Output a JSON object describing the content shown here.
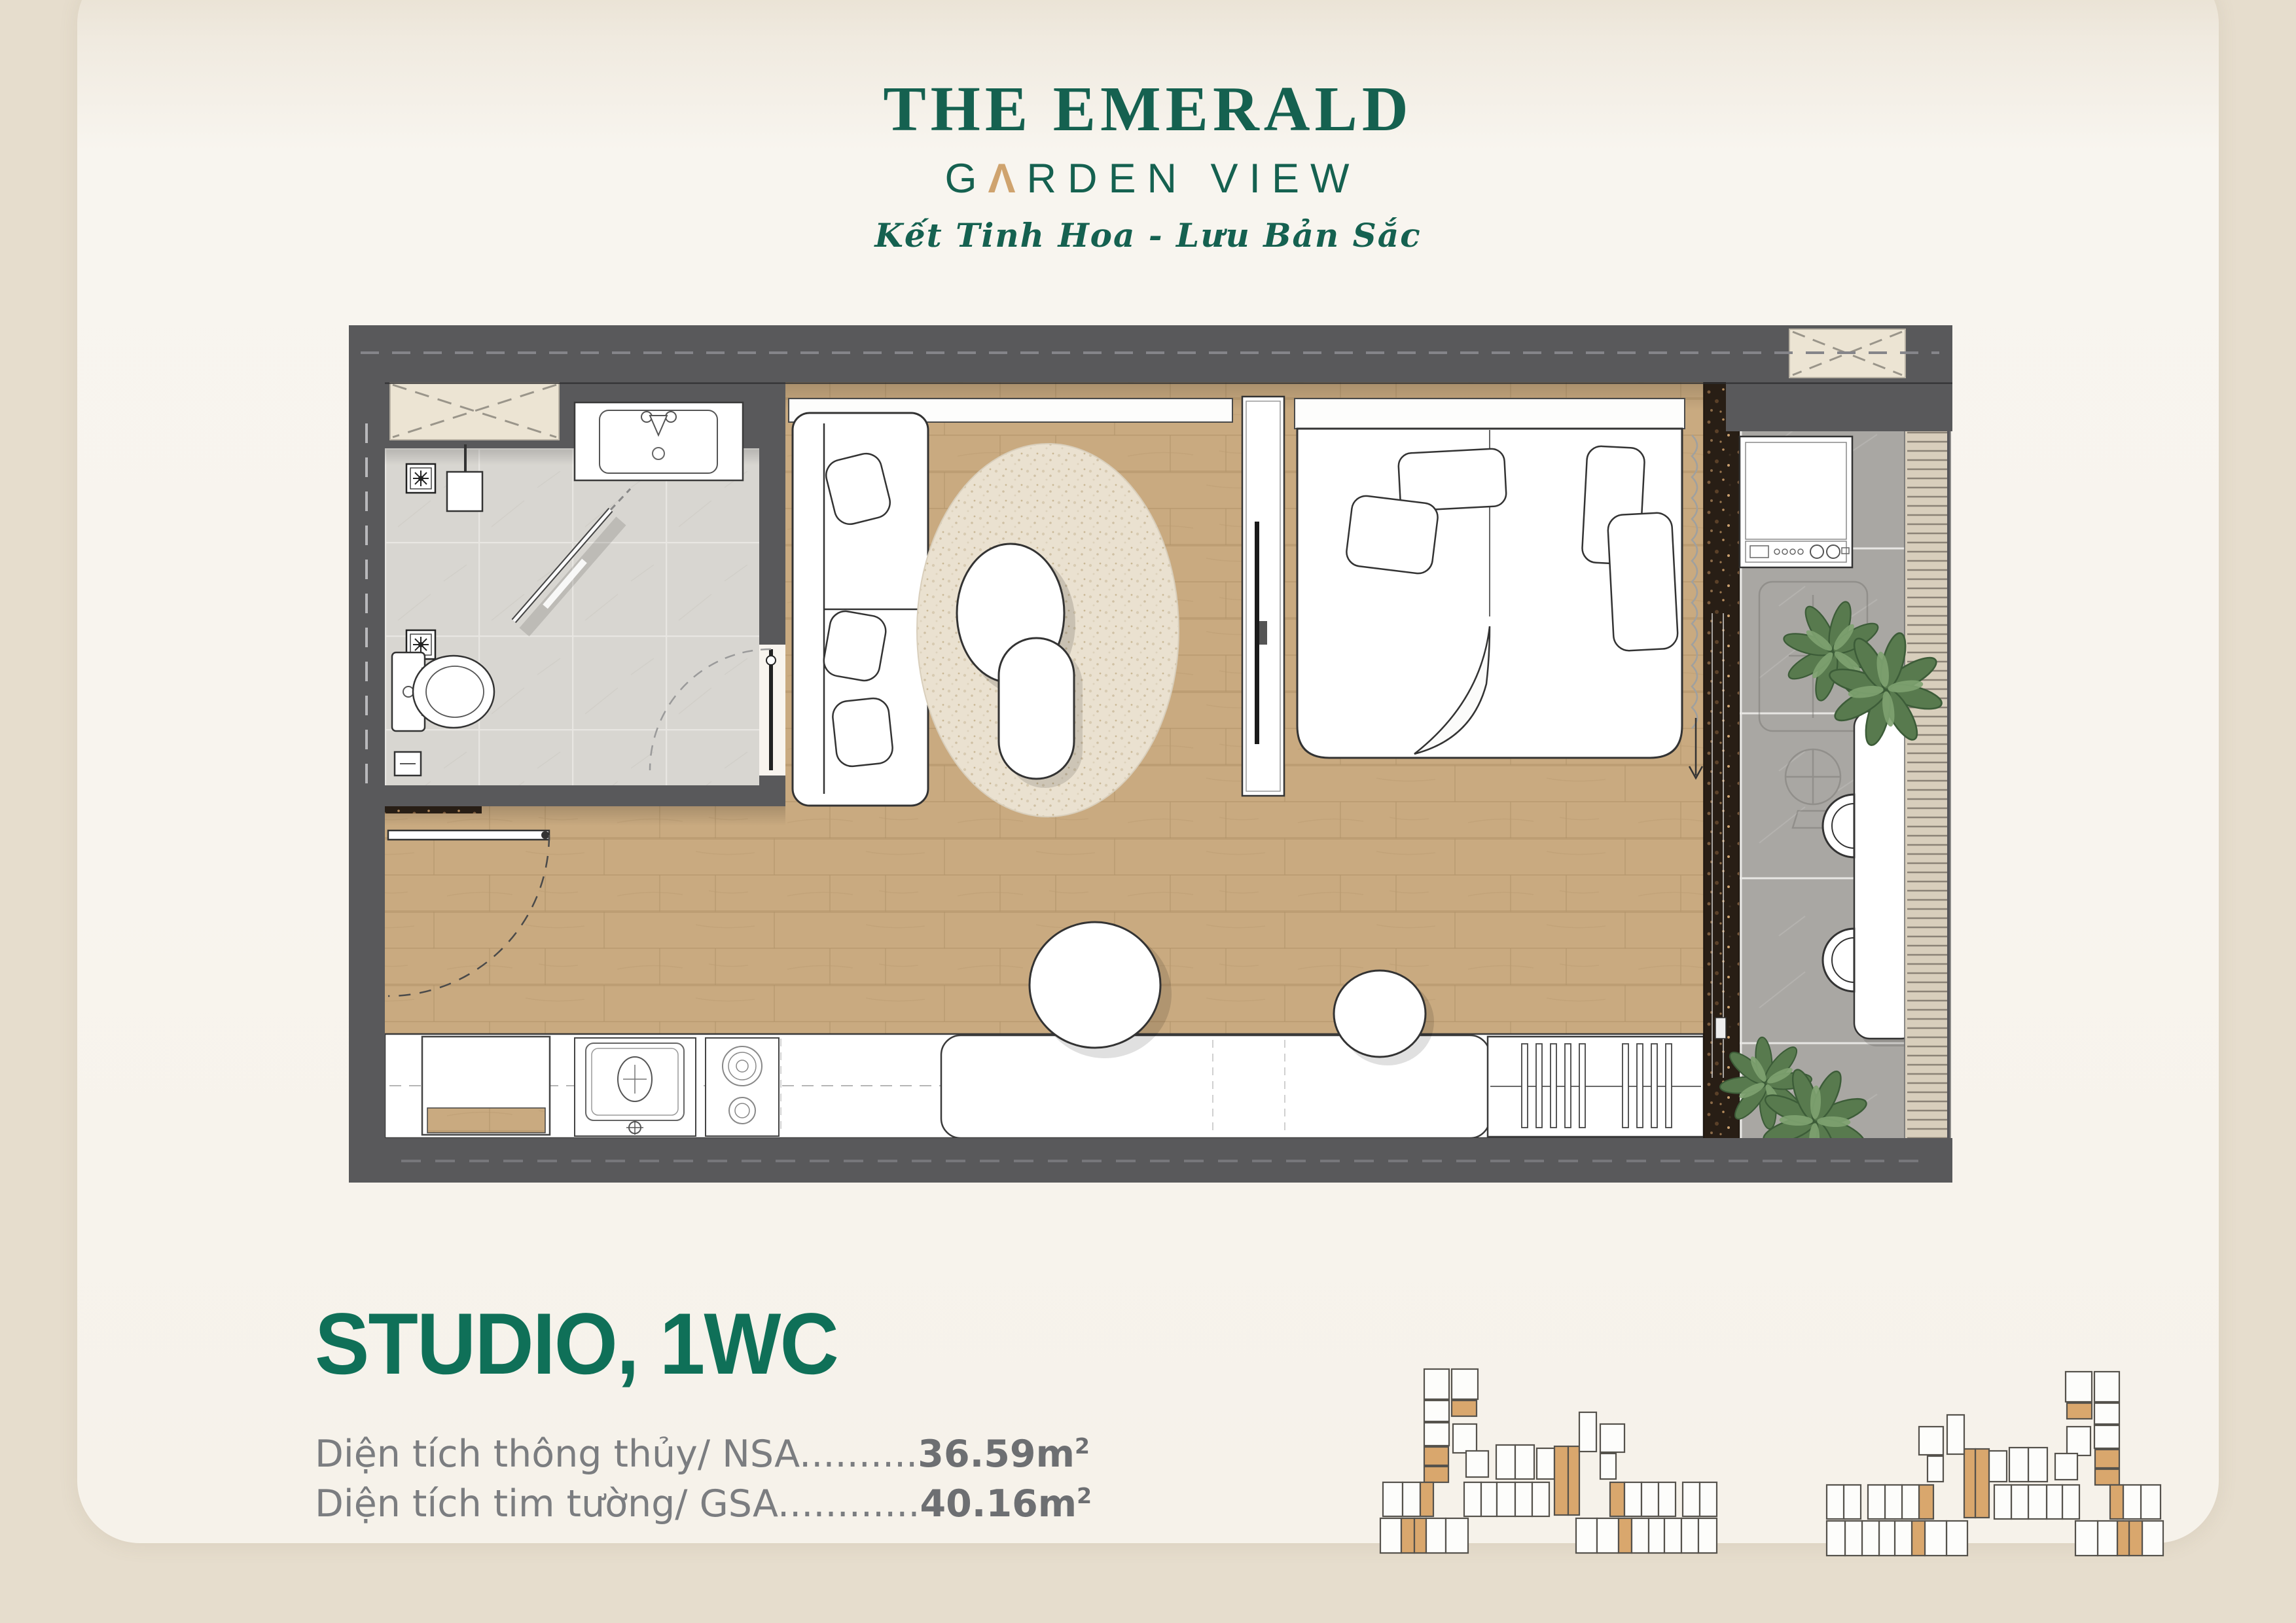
{
  "page": {
    "background_top": "#ece4d7",
    "background_bottom": "#d4c9b9",
    "card_color": "#f8f5ef"
  },
  "brand": {
    "title": "THE EMERALD",
    "garden": {
      "g": "G",
      "a": "Λ",
      "rest": "RDEN VIEW"
    },
    "tagline": "Kết Tinh Hoa - Lưu Bản Sắc",
    "green": "#156150",
    "gold": "#cfa36e"
  },
  "unit": {
    "title": "STUDIO, 1WC",
    "areas": [
      {
        "label": "Diện tích thông thủy/ NSA",
        "dots": "..........",
        "value": "36.59",
        "suffix": "m",
        "sup": "2"
      },
      {
        "label": "Diện tích tim tường/ GSA",
        "dots": "............",
        "value": "40.16",
        "suffix": "m",
        "sup": "2"
      }
    ]
  },
  "floorplan": {
    "rooms": [
      "bathroom",
      "living-bedroom",
      "kitchen",
      "balcony"
    ],
    "colors": {
      "wall": "#59595b",
      "wood_floor": "#c9aa80",
      "bath_tile": "#d8d6d1",
      "balcony_tile": "#a9a7a3",
      "granite_sill": "#281e15",
      "shaft_hatch": "#ece4d3",
      "furniture_stroke": "#333333",
      "rug": "#eae1d0"
    }
  },
  "key_plan": {
    "unit_fill": "#fdfdfb",
    "unit_stroke": "#55524c",
    "highlight": "#d9a76d",
    "cluster_width": 524,
    "clusters": [
      {
        "mirror": false
      },
      {
        "mirror": true
      }
    ],
    "rects": [
      [
        76,
        8,
        38,
        46
      ],
      [
        118,
        8,
        40,
        46
      ],
      [
        76,
        56,
        38,
        32
      ],
      [
        118,
        56,
        38,
        24,
        1
      ],
      [
        76,
        90,
        38,
        35
      ],
      [
        120,
        92,
        36,
        44
      ],
      [
        76,
        127,
        37,
        28,
        1
      ],
      [
        76,
        157,
        37,
        24,
        1
      ],
      [
        140,
        133,
        34,
        40
      ],
      [
        186,
        124,
        29,
        52
      ],
      [
        215,
        124,
        29,
        52
      ],
      [
        248,
        129,
        27,
        47
      ],
      [
        275,
        126,
        21,
        105,
        1
      ],
      [
        296,
        126,
        17,
        105,
        1
      ],
      [
        313,
        74,
        26,
        60
      ],
      [
        345,
        92,
        37,
        43
      ],
      [
        345,
        137,
        24,
        39
      ],
      [
        13,
        181,
        30,
        52
      ],
      [
        43,
        181,
        27,
        52
      ],
      [
        70,
        181,
        20,
        52,
        1
      ],
      [
        137,
        181,
        26,
        52
      ],
      [
        163,
        181,
        24,
        52
      ],
      [
        187,
        181,
        28,
        52
      ],
      [
        215,
        181,
        26,
        52
      ],
      [
        241,
        181,
        26,
        52
      ],
      [
        360,
        181,
        22,
        52,
        1
      ],
      [
        382,
        181,
        26,
        52
      ],
      [
        408,
        181,
        26,
        52
      ],
      [
        434,
        181,
        26,
        52
      ],
      [
        471,
        181,
        26,
        52
      ],
      [
        497,
        181,
        26,
        52
      ],
      [
        9,
        236,
        32,
        53
      ],
      [
        41,
        236,
        20,
        53,
        1
      ],
      [
        61,
        236,
        18,
        53,
        1
      ],
      [
        79,
        236,
        30,
        53
      ],
      [
        109,
        236,
        34,
        53
      ],
      [
        308,
        236,
        32,
        53
      ],
      [
        340,
        236,
        33,
        53
      ],
      [
        373,
        236,
        20,
        53,
        1
      ],
      [
        393,
        236,
        26,
        53
      ],
      [
        419,
        236,
        24,
        53
      ],
      [
        443,
        236,
        26,
        53
      ],
      [
        469,
        236,
        26,
        53
      ],
      [
        495,
        236,
        28,
        53
      ]
    ]
  }
}
